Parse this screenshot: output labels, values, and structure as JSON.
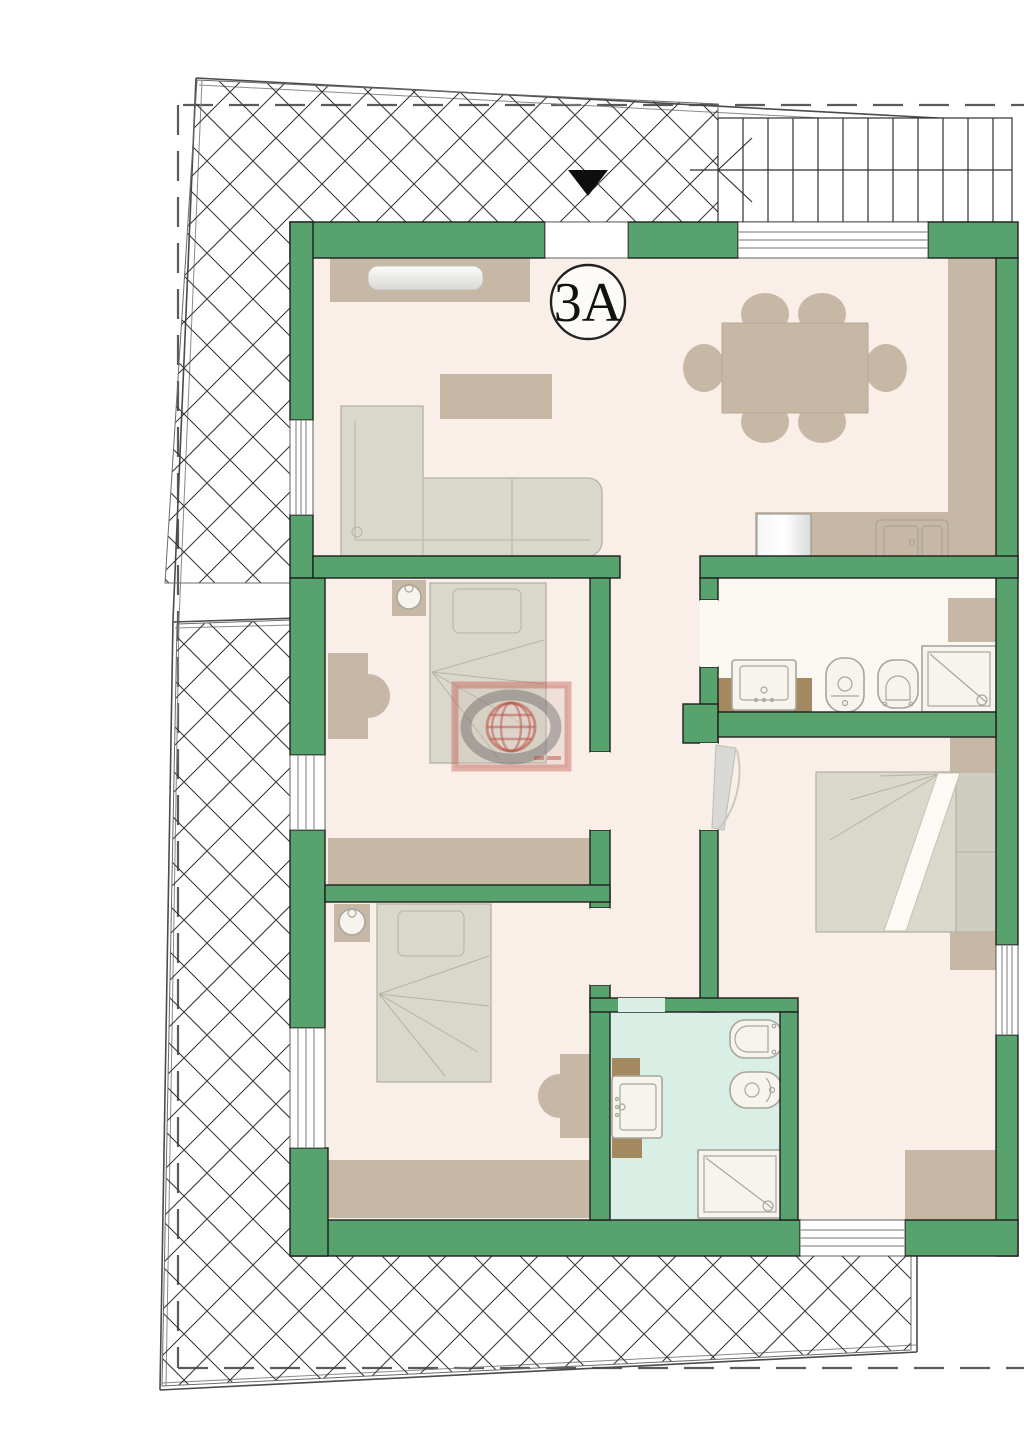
{
  "plan": {
    "unit_label": "3A",
    "palette": {
      "wall_green": "#57a26d",
      "wall_outline": "#1e1e1e",
      "floor_cream": "#f9efe8",
      "floor_bath_white": "#fbf8f3",
      "floor_bath_teal": "#d9efe5",
      "furniture_tan": "#c7b8a5",
      "vanity_brown": "#a48960",
      "soft_gray": "#d9d8cb",
      "hatch_line": "#3a3a3a",
      "boundary_line": "#4b4b4b",
      "watermark_red": "#c04a3e"
    },
    "symbols": [
      "terrace-crosshatch",
      "staircase",
      "entrance-arrow",
      "unit-label-badge",
      "watermark-globe-logo",
      "lot-boundary",
      "setback-dashed-line"
    ],
    "furniture": [
      "tv-sideboard",
      "dining-table-6-chairs",
      "coffee-table",
      "corner-sofa",
      "kitchen-counter",
      "refrigerator",
      "kitchen-sink",
      "single-bed",
      "desk-with-chair",
      "wardrobe",
      "nightstand-lamp",
      "double-bed",
      "washbasin",
      "bidet",
      "toilet",
      "shower-tray"
    ]
  }
}
